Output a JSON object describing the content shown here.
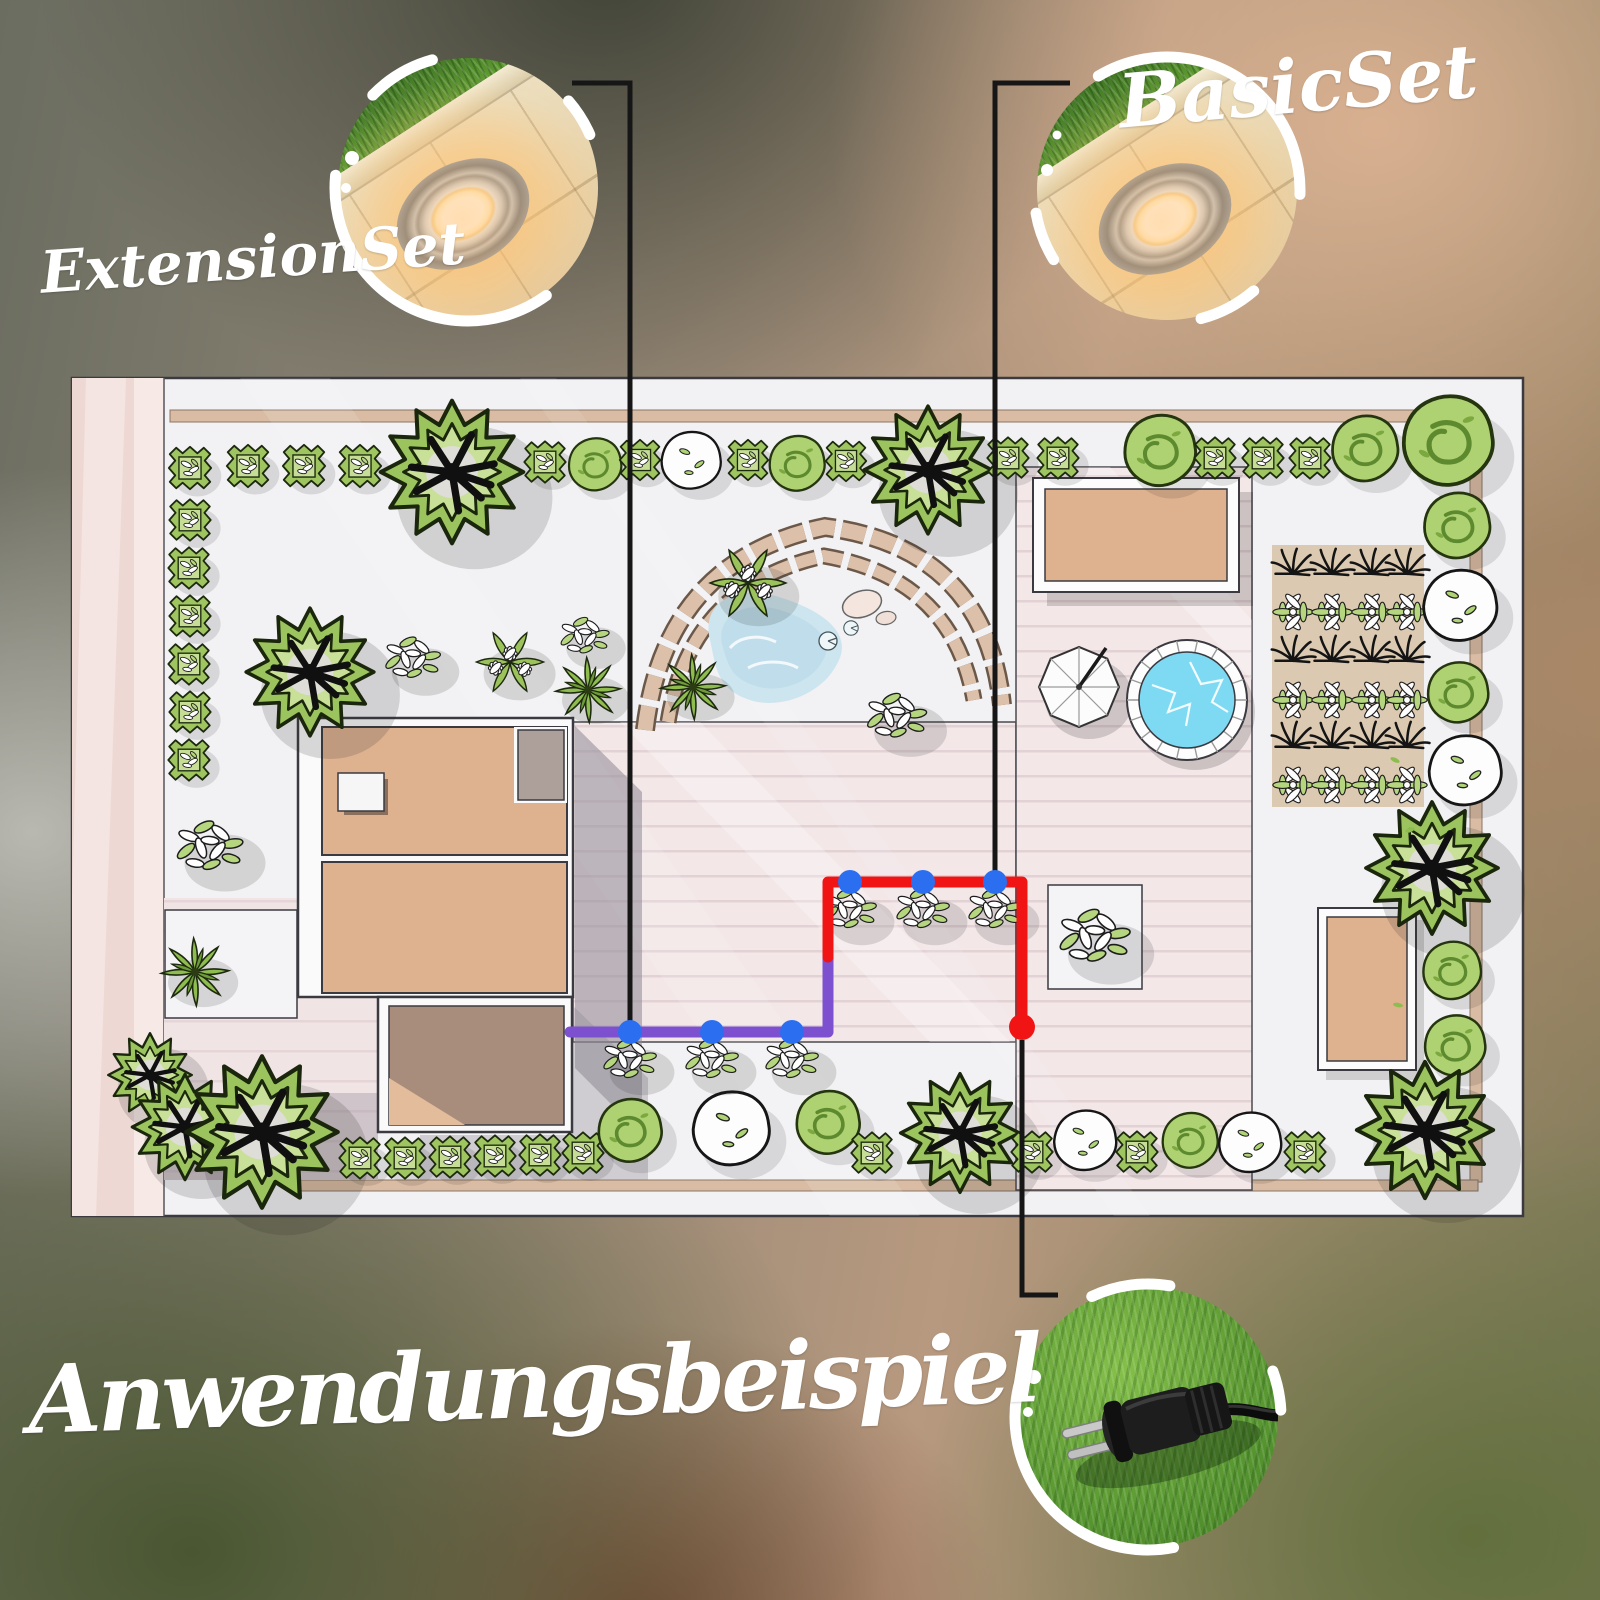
{
  "page": {
    "title": "Anwendungsbeispiel"
  },
  "sets": {
    "extension": {
      "label": "ExtensionSet",
      "cable_color": "#7C50CE",
      "light_count": 3
    },
    "basic": {
      "label": "BasicSet",
      "cable_color": "#F11414",
      "light_count": 3
    }
  },
  "markers": {
    "light_dot_color": "#2B6FF0",
    "plug_dot_color": "#F11414",
    "callout_line_color": "#161616",
    "label_text_color": "#FFFFFF"
  },
  "insets": {
    "extension_icon": "recessed-ground-light-photo",
    "basic_icon": "recessed-ground-light-photo",
    "plug_icon": "outdoor-power-plug-photo"
  }
}
